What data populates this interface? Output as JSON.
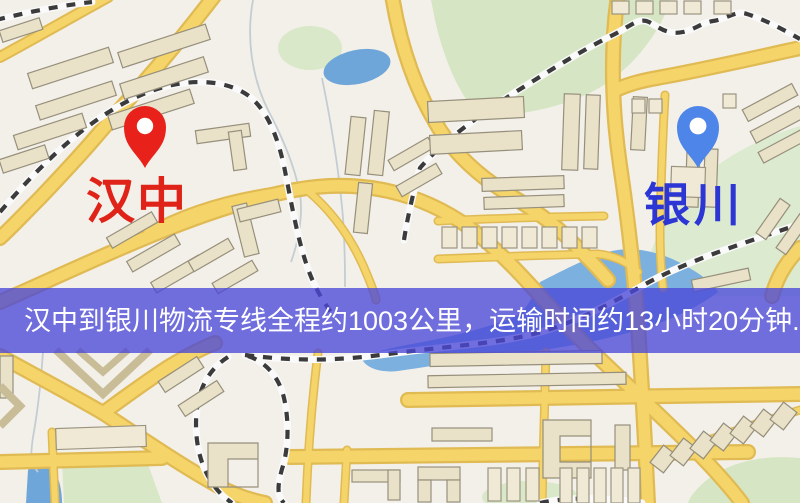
{
  "banner": {
    "text": "汉中到银川物流专线全程约1003公里，运输时间约13小时20分钟.",
    "bg_color": "#4a48d8",
    "text_color": "#ffffff"
  },
  "markers": {
    "origin": {
      "label": "汉中",
      "pin_color": "#e8211a",
      "label_color": "#e02318"
    },
    "destination": {
      "label": "银川",
      "pin_color": "#4d85e9",
      "label_color": "#2b36d4"
    }
  },
  "route": {
    "distance_km": "1003",
    "duration_text": "13小时20分钟"
  },
  "map_colors": {
    "background": "#f3f0ea",
    "park": "#d8e7c6",
    "water": "#6fa6d9",
    "road": "#f5d46a",
    "railway": "#3b3b3b"
  }
}
